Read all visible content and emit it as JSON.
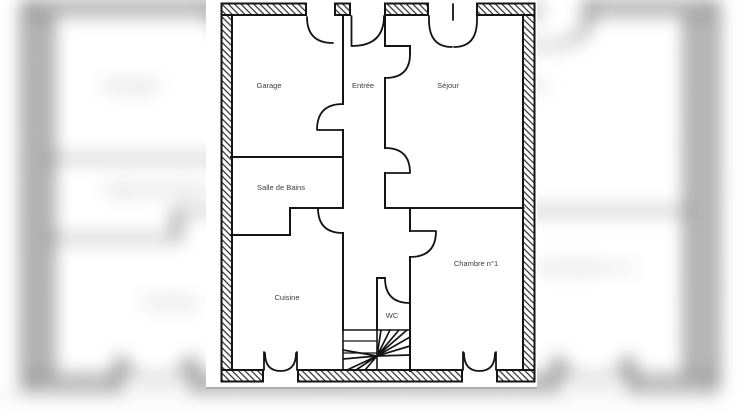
{
  "floor_plan": {
    "title": "Plan de maison - rez-de-chaussée",
    "rooms": [
      {
        "id": "garage",
        "label": "Garage"
      },
      {
        "id": "entree",
        "label": "Entrée"
      },
      {
        "id": "sejour",
        "label": "Séjour"
      },
      {
        "id": "salle_de_bains",
        "label": "Salle de Bains"
      },
      {
        "id": "cuisine",
        "label": "Cuisine"
      },
      {
        "id": "wc",
        "label": "WC"
      },
      {
        "id": "chambre_1",
        "label": "Chambre n°1"
      }
    ],
    "colors": {
      "line": "#141414",
      "label_text": "#3d3d3d",
      "paper": "#ffffff",
      "photo_edge": "#949494"
    }
  }
}
